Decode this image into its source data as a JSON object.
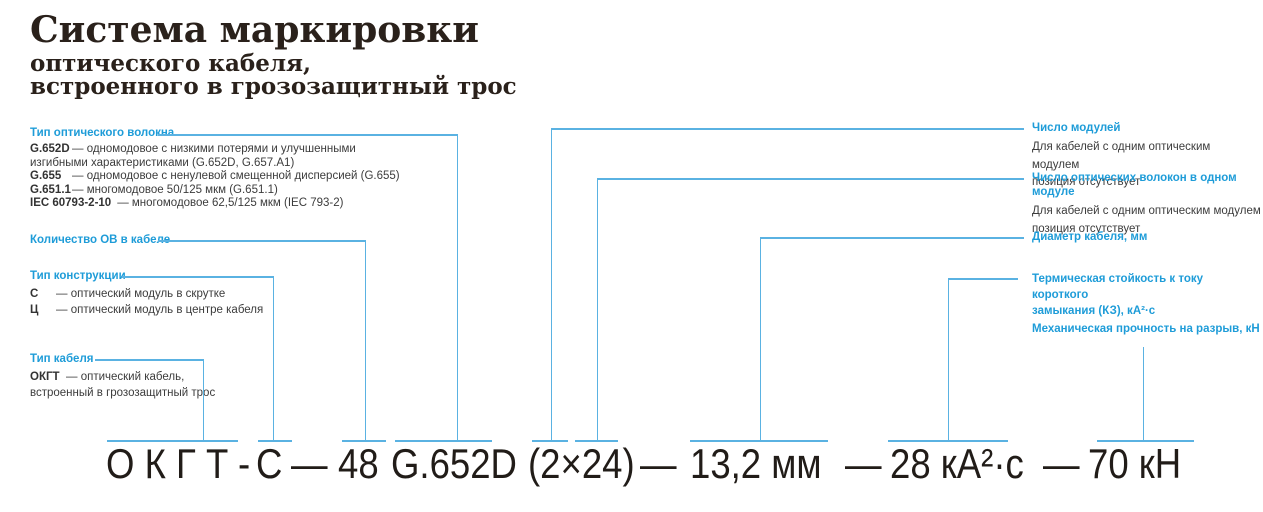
{
  "title": {
    "main": "Система маркировки",
    "sub1": "оптического кабеля,",
    "sub2": "встроенного в грозозащитный трос"
  },
  "left": {
    "fiber_type": {
      "header": "Тип оптического волокна",
      "items": [
        {
          "code": "G.652D",
          "line1": "— одномодовое с низкими потерями и улучшенными",
          "line2": "изгибными характеристиками (G.652D, G.657.A1)"
        },
        {
          "code": "G.655",
          "line1": "— одномодовое с ненулевой смещенной дисперсией (G.655)"
        },
        {
          "code": "G.651.1",
          "line1": "— многомодовое 50/125 мкм (G.651.1)"
        },
        {
          "code": "IEC 60793-2-10",
          "line1": "— многомодовое 62,5/125 мкм (IEC 793-2)"
        }
      ]
    },
    "fiber_count": {
      "header": "Количество ОВ в кабеле"
    },
    "construction": {
      "header": "Тип конструкции",
      "items": [
        {
          "code": "С",
          "line1": "— оптический модуль в скрутке"
        },
        {
          "code": "Ц",
          "line1": "— оптический модуль в центре кабеля"
        }
      ]
    },
    "cable_type": {
      "header": "Тип кабеля",
      "code": "ОКГТ",
      "line1": "— оптический кабель,",
      "line2": "встроенный в грозозащитный трос"
    }
  },
  "right": {
    "modules": {
      "header": "Число модулей",
      "line1": "Для кабелей с одним оптическим модулем",
      "line2": "позиция отсутствует"
    },
    "fibers_per_module": {
      "header": "Число оптических волокон в одном модуле",
      "line1": "Для кабелей с одним оптическим модулем",
      "line2": "позиция отсутствует"
    },
    "diameter": {
      "header": "Диаметр кабеля, мм"
    },
    "thermal": {
      "header_line1": "Термическая стойкость к току короткого",
      "header_line2": "замыкания (КЗ), кА²·с"
    },
    "mechanical": {
      "header": "Механическая прочность на разрыв, кН"
    }
  },
  "marking": {
    "cable_type": "О К Г Т",
    "hyphen": "-",
    "construction": "С",
    "dash1": "—",
    "fiber_count": "48",
    "fiber_type": "G.652D",
    "modules": "(2×24)",
    "dash2": "—",
    "diameter": "13,2 мм",
    "dash3": "—",
    "thermal": "28 кА²·с",
    "dash4": "—",
    "strength": "70 кН"
  },
  "colors": {
    "connector_blue": "#5ab2e2",
    "label_blue": "#1e9cd8",
    "title_dark": "#2a211b",
    "body_text": "#3c3c3c",
    "marking_dark": "#211c18"
  }
}
